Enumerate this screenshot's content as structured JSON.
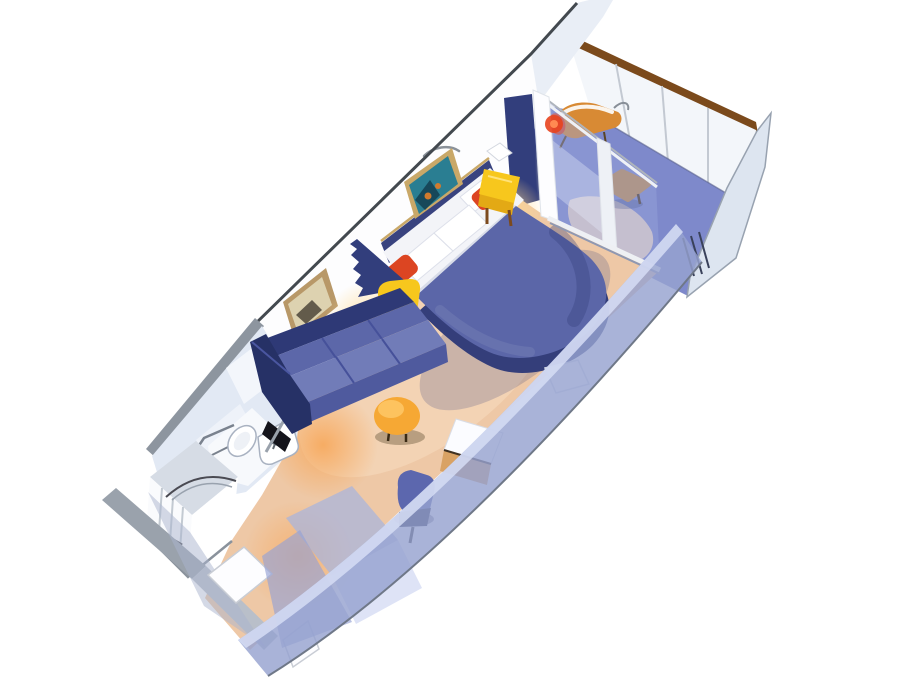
{
  "scene": {
    "type": "cruise-ship-stateroom-cutaway-3d-floorplan",
    "areas": [
      "balcony",
      "sleeping-area",
      "sitting-area",
      "bathroom",
      "entry-corridor"
    ],
    "furniture": [
      "bed",
      "pillows",
      "red-accent-pillows",
      "nightstand-left",
      "nightstand-right",
      "sofa",
      "ottoman",
      "vanity-desk",
      "desk-chair",
      "wardrobe",
      "balcony-chair",
      "balcony-table",
      "toilet",
      "sink",
      "shower",
      "wall-art-reef",
      "wall-art-beige"
    ]
  },
  "palette": {
    "white": "#ffffff",
    "wall_edge": "#43494f",
    "wall_face": "#fdfdfe",
    "end_wall_edge": "#8d959f",
    "divider_slab": "#e9eef6",
    "ledge": "#aab2bc",
    "partition_slab": "#dde5f0",
    "partition_edge": "#98a2b0",
    "partition_post": "#39415a",
    "rail_cap": "#7b4a1c",
    "rail_face": "#f3f6fa",
    "rail_seam": "#c3c9d2",
    "rail_base": "#5a628c",
    "balcony_floor": "#7e89cb",
    "balcony_warm": "#f2d9c4",
    "navy_panel": "#2e3a74",
    "navy_wall": "#323e7c",
    "gray_block": "#9aa3b0",
    "headboard": "#39437f",
    "headboard_trim": "#c9a868",
    "picture1_frame": "#c9a868",
    "picture1_art": "#2a7e92",
    "picture1_art_dark": "#17485a",
    "picture1_art_orange": "#d17a2e",
    "picture2_frame": "#b89868",
    "picture2_art": "#ddd2b0",
    "picture2_art_dark": "#4e463a",
    "sconce": "#8a9199",
    "lamp_edge": "#d3d7df",
    "bed_main": "#5b66a8",
    "bed_side": "#343e7a",
    "bed_shadow": "#3a4680",
    "pillow_white": "#ffffff",
    "pillow_edge": "#dde0ea",
    "pillow_red": "#dc4522",
    "sheet_band": "#f3f4f8",
    "sheet_line": "#d8dce8",
    "nightstand_top": "#f7c71d",
    "nightstand_side": "#e3a915",
    "nightstand_leg": "#7c4a1e",
    "nightstand_hi": "#ffe27a",
    "sofa_back": "#2e3976",
    "sofa_mid": "#5c67a9",
    "sofa_seat": "#717cb8",
    "sofa_front": "#4f5a9e",
    "sofa_arm": "#263166",
    "sofa_seam": "#46519a",
    "sofa_arm_hi": "#4a56a0",
    "ottoman": "#f6a834",
    "ottoman_hi": "#ffc96a",
    "ottoman_leg": "#3a2a14",
    "ottoman_shadow": "#4a3c20",
    "floor_base": "#eec8a6",
    "floor_cream": "#f7ddc0",
    "glow_warm": "#ffd98e",
    "glow_hot": "#ffcf78",
    "glow_deep": "#f7a85b",
    "post_glow": "#fff6dc",
    "desk_top": "#fbfcff",
    "desk_edge": "#d9dde6",
    "desk_front": "#d9a264",
    "desk_front_edge": "#3f3122",
    "chair_blue": "#5c67ae",
    "chair_dark": "#1d2444",
    "chair_leg": "#2c2c36",
    "glass_tint": "#96a3db",
    "glass_streak": "#e9edfb",
    "door_frame": "#fdfdff",
    "door_frame_edge": "#e0e4ea",
    "door_mid_frame": "#eef1f6",
    "door_rail": "#aeb4bc",
    "sill_hi": "#eef0f4",
    "sill_shadow": "#8f98b2",
    "flare_red": "#e8431e",
    "flare_core": "#ff8a52",
    "front_wall": "#96a2d0",
    "front_wall_hi": "#d6ddf4",
    "front_wall_edge": "#6f7888",
    "wardrobe_a": "#a8b4de",
    "wardrobe_b": "#c6cff0",
    "wardrobe_c": "#96a2d4",
    "bath_wall": "#e2e9f4",
    "bath_wall_light": "#f3f6fb",
    "bath_wall_mid": "#eef2f9",
    "bath_floor": "#f7f9fc",
    "fixture_white": "#ffffff",
    "fixture_inner": "#eef1f6",
    "fixture_edge": "#a9b2c1",
    "faucet": "#606870",
    "towel_bar": "#7a828e",
    "dark_gap": "#14141b",
    "shower_top": "#d6dce5",
    "shower_face": "#fafbfd",
    "shower_face_r": "#ffffff",
    "shower_stripe": "#c3cad2",
    "shower_line": "#4a4a52",
    "shower_arc2": "#99a2ae",
    "shower_base": "#8a929c",
    "entry_gray_a": "#9aa2ac",
    "entry_gray_b": "#b9bfc9",
    "entry_wedge": "#aab4cd",
    "door_white": "#fdfdff",
    "door_white_edge": "#c9cdd5",
    "bench_white": "#fcfcff",
    "bench_edge": "#d9dde7",
    "balcony_chair": "#d88a34",
    "balcony_chair_leg": "#5a4426",
    "balcony_chair_arm": "#888f98",
    "balcony_cushion": "#e04424",
    "balcony_table": "#c08a4a",
    "table_leg": "#4a3318",
    "table_shadow": "#32406e"
  }
}
